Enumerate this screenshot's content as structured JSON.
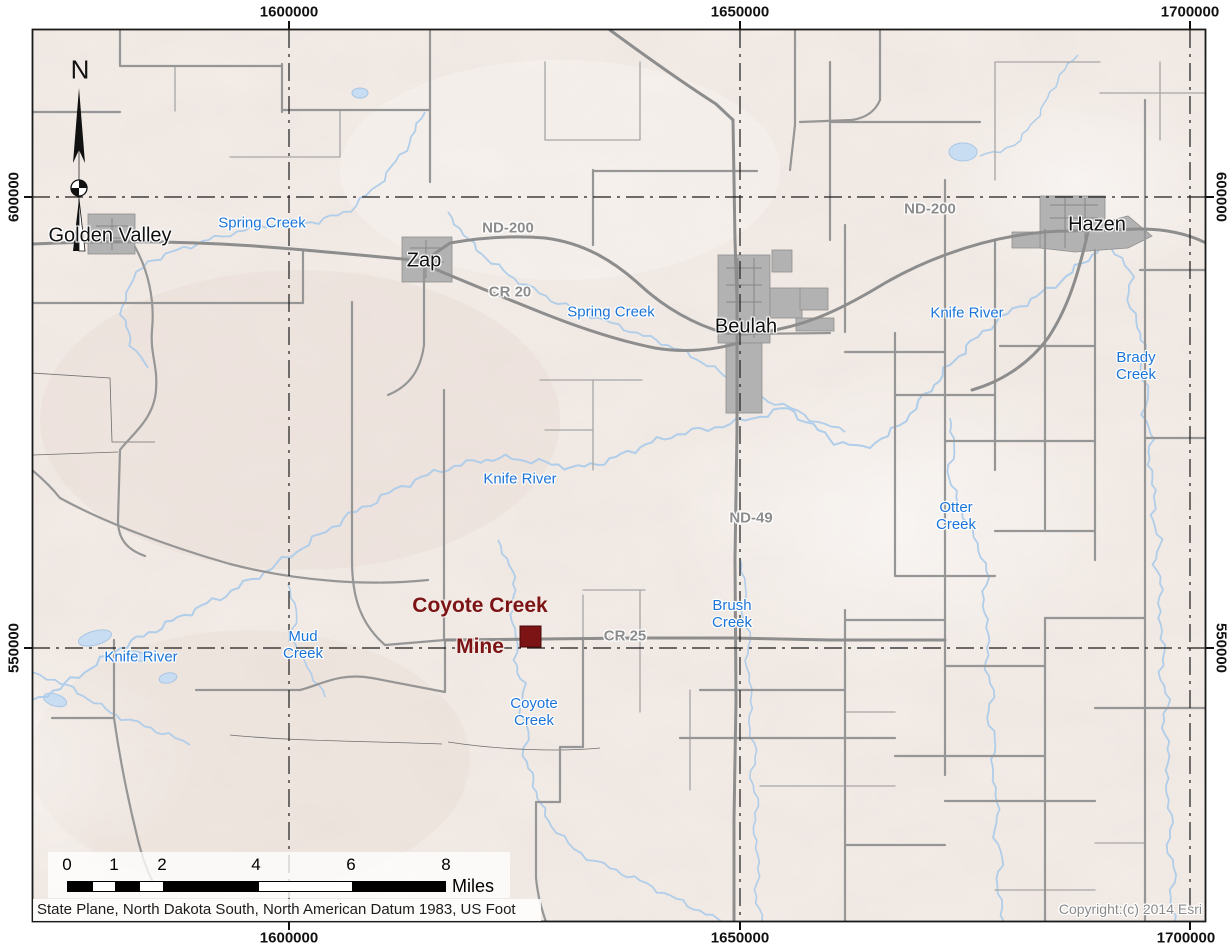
{
  "grid": {
    "top_labels": [
      "1600000",
      "1650000",
      "1700000"
    ],
    "bottom_labels": [
      "1600000",
      "1650000",
      "1700000"
    ],
    "left_labels": [
      "600000",
      "550000"
    ],
    "right_labels": [
      "600000",
      "550000"
    ]
  },
  "north_arrow_label": "N",
  "towns": [
    {
      "name": "Golden Valley"
    },
    {
      "name": "Zap"
    },
    {
      "name": "Beulah"
    },
    {
      "name": "Hazen"
    }
  ],
  "road_labels": [
    {
      "text": "ND-200"
    },
    {
      "text": "CR 20"
    },
    {
      "text": "ND-200"
    },
    {
      "text": "ND-49"
    },
    {
      "text": "CR 25"
    }
  ],
  "water_labels": [
    {
      "text": "Spring Creek"
    },
    {
      "text": "Spring Creek"
    },
    {
      "text": "Knife River"
    },
    {
      "text": "Brady\nCreek"
    },
    {
      "text": "Knife River"
    },
    {
      "text": "Otter\nCreek"
    },
    {
      "text": "Brush\nCreek"
    },
    {
      "text": "Mud\nCreek"
    },
    {
      "text": "Knife River"
    },
    {
      "text": "Coyote\nCreek"
    }
  ],
  "mine": {
    "name_line1": "Coyote Creek",
    "name_line2": "Mine",
    "marker_color": "#7c1315"
  },
  "scale_bar": {
    "tick_labels": [
      "0",
      "1",
      "2",
      "4",
      "6",
      "8"
    ],
    "unit_label": "Miles"
  },
  "footer": {
    "datum_text": "State Plane, North Dakota South, North American Datum 1983, US Foot",
    "copyright_text": "Copyright:(c) 2014 Esri"
  },
  "colors": {
    "water": "#b0cde9",
    "water_label": "#1b74d8",
    "road_major": "#8d8d8d",
    "road_label": "#8c8c8c",
    "town_fill": "#b2b2b2",
    "mine": "#7c1315",
    "grid_line": "#1c1c1c",
    "terrain_base": "#f3ece7"
  }
}
